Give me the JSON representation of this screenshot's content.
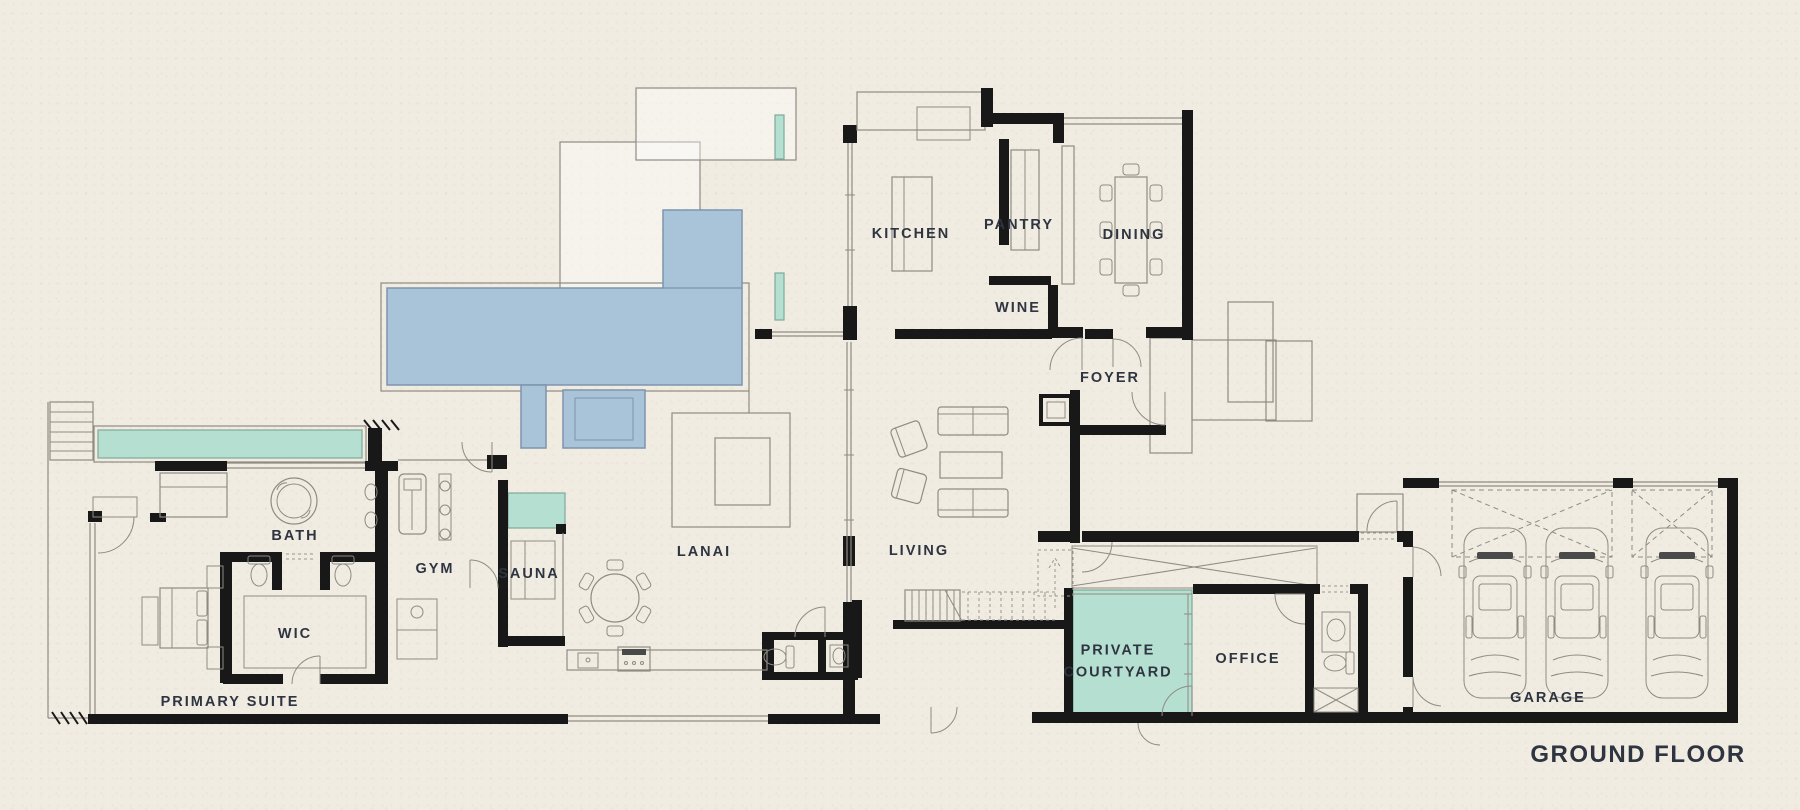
{
  "title": "GROUND FLOOR",
  "rooms": [
    {
      "id": "kitchen",
      "label": "KITCHEN"
    },
    {
      "id": "pantry",
      "label": "PANTRY"
    },
    {
      "id": "wine",
      "label": "WINE"
    },
    {
      "id": "dining",
      "label": "DINING"
    },
    {
      "id": "foyer",
      "label": "FOYER"
    },
    {
      "id": "bath",
      "label": "BATH"
    },
    {
      "id": "gym",
      "label": "GYM"
    },
    {
      "id": "sauna",
      "label": "SAUNA"
    },
    {
      "id": "lanai",
      "label": "LANAI"
    },
    {
      "id": "living",
      "label": "LIVING"
    },
    {
      "id": "wic",
      "label": "WIC"
    },
    {
      "id": "primary_suite",
      "label": "PRIMARY SUITE"
    },
    {
      "id": "private_courtyard",
      "label": "PRIVATE COURTYARD"
    },
    {
      "id": "office",
      "label": "OFFICE"
    },
    {
      "id": "garage",
      "label": "GARAGE"
    }
  ],
  "features": {
    "garage_car_count": 3
  },
  "colors": {
    "background": "#f1ece2",
    "wall": "#181818",
    "line": "#8f8b83",
    "pool": "#a9c3d9",
    "pool_border": "#7d94ad",
    "water": "#b5dfd0",
    "water_border": "#7fa99a",
    "text": "#2e3440"
  }
}
